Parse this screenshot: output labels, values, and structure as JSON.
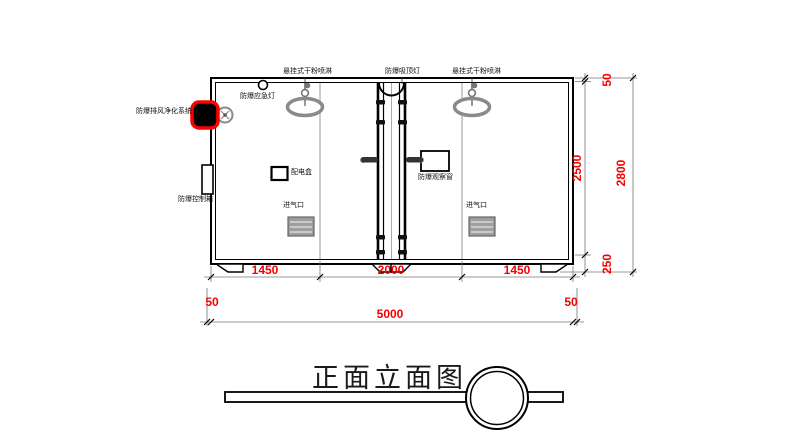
{
  "drawing": {
    "title": "正面立面图"
  },
  "labels": {
    "spray_left": "悬挂式干粉喷淋",
    "ceiling_lamp": "防爆吸顶灯",
    "spray_right": "悬挂式干粉喷淋",
    "emergency_lamp": "防爆应急灯",
    "purification_system": "防爆排风净化系统",
    "control_box": "防爆控制箱",
    "power_box": "配电盒",
    "observation_window": "防爆观察窗",
    "air_inlet_left": "进气口",
    "air_inlet_right": "进气口"
  },
  "dimensions": {
    "bottom_row": [
      "1450",
      "2000",
      "1450"
    ],
    "bottom_side_left": "50",
    "bottom_total": "5000",
    "bottom_side_right": "50",
    "right_col": {
      "top": "50",
      "middle": "2500",
      "bottom": "250",
      "total": "2800"
    }
  },
  "colors": {
    "dimension_text": "#f40000",
    "highlight": "#ff0000",
    "line": "#000000",
    "fixture_gray": "#808080"
  }
}
